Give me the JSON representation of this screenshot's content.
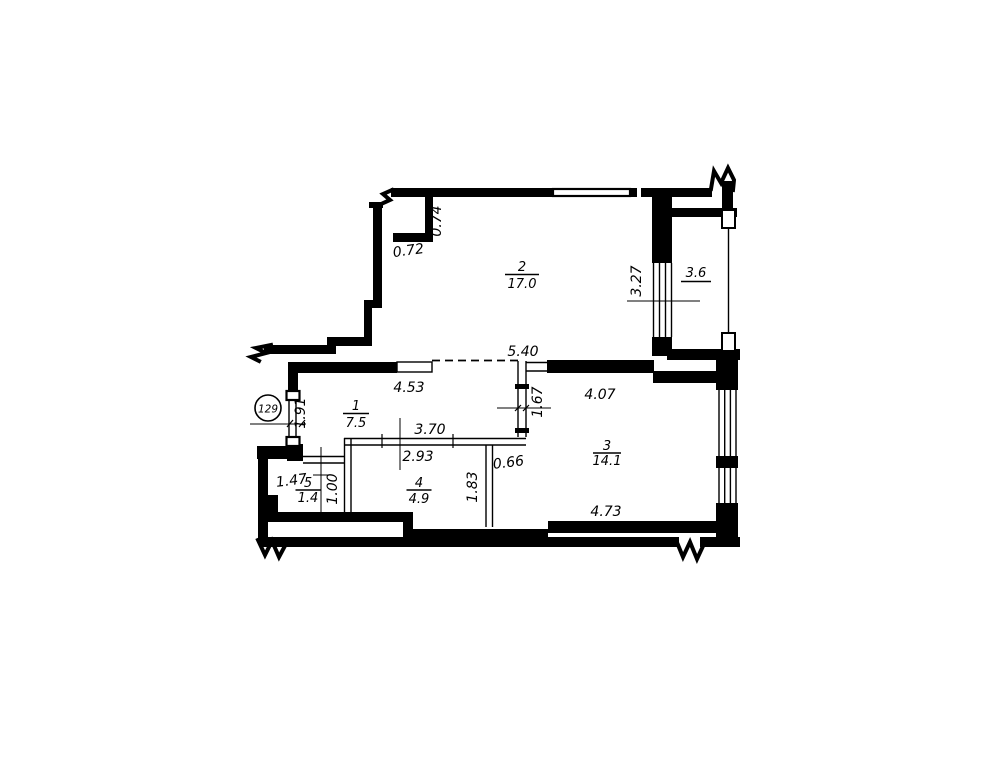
{
  "drawing": {
    "type": "apartment floor plan",
    "apartment_badge": "129",
    "rooms": [
      {
        "id": "room-1",
        "number": "1",
        "area": "7.5"
      },
      {
        "id": "room-2",
        "number": "2",
        "area": "17.0"
      },
      {
        "id": "room-3",
        "number": "3",
        "area": "14.1"
      },
      {
        "id": "room-4",
        "number": "4",
        "area": "4.9"
      },
      {
        "id": "room-5",
        "number": "5",
        "area": "1.4"
      },
      {
        "id": "balcony",
        "number": "",
        "area": "3.6"
      }
    ],
    "dimensions": [
      {
        "id": "dim-074",
        "text": "0.74"
      },
      {
        "id": "dim-072",
        "text": "0.72"
      },
      {
        "id": "dim-327",
        "text": "3.27"
      },
      {
        "id": "dim-540",
        "text": "5.40"
      },
      {
        "id": "dim-453",
        "text": "4.53"
      },
      {
        "id": "dim-191",
        "text": "1.91"
      },
      {
        "id": "dim-167",
        "text": "1.67"
      },
      {
        "id": "dim-407",
        "text": "4.07"
      },
      {
        "id": "dim-370",
        "text": "3.70"
      },
      {
        "id": "dim-293",
        "text": "2.93"
      },
      {
        "id": "dim-066",
        "text": "0.66"
      },
      {
        "id": "dim-147",
        "text": "1.47"
      },
      {
        "id": "dim-100",
        "text": "1.00"
      },
      {
        "id": "dim-183",
        "text": "1.83"
      },
      {
        "id": "dim-473",
        "text": "4.73"
      }
    ],
    "colors": {
      "ink": "#000000",
      "paper": "#ffffff"
    }
  }
}
